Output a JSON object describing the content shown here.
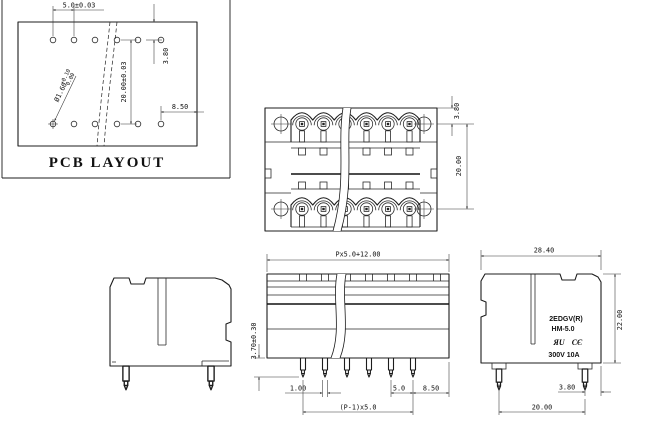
{
  "pcb": {
    "title": "PCB LAYOUT",
    "dim_pitch": "5.0±0.03",
    "dim_edge": "3.80",
    "dim_rows": "20.00±0.03",
    "dim_right": "8.50",
    "hole_dia": "Ø1.60",
    "hole_tol_plus": "+0.10",
    "hole_tol_minus": "0.00"
  },
  "top": {
    "dim_edge": "3.80",
    "dim_rows": "20.00"
  },
  "front": {
    "dim_width": "Px5.0+12.00",
    "dim_pin_len": "3.70±0.30",
    "dim_pin_w": "1.00",
    "dim_pitch": "5.0",
    "dim_end": "8.50",
    "dim_span": "(P-1)x5.0"
  },
  "side": {
    "dim_depth": "28.40",
    "dim_height": "22.00",
    "dim_pin_edge": "3.80",
    "dim_rows": "20.00",
    "model": "2EDGV(R)",
    "series": "HM-5.0",
    "rating": "300V 10A",
    "ul_mark": "ЯU",
    "ce_mark": "CЄ"
  }
}
